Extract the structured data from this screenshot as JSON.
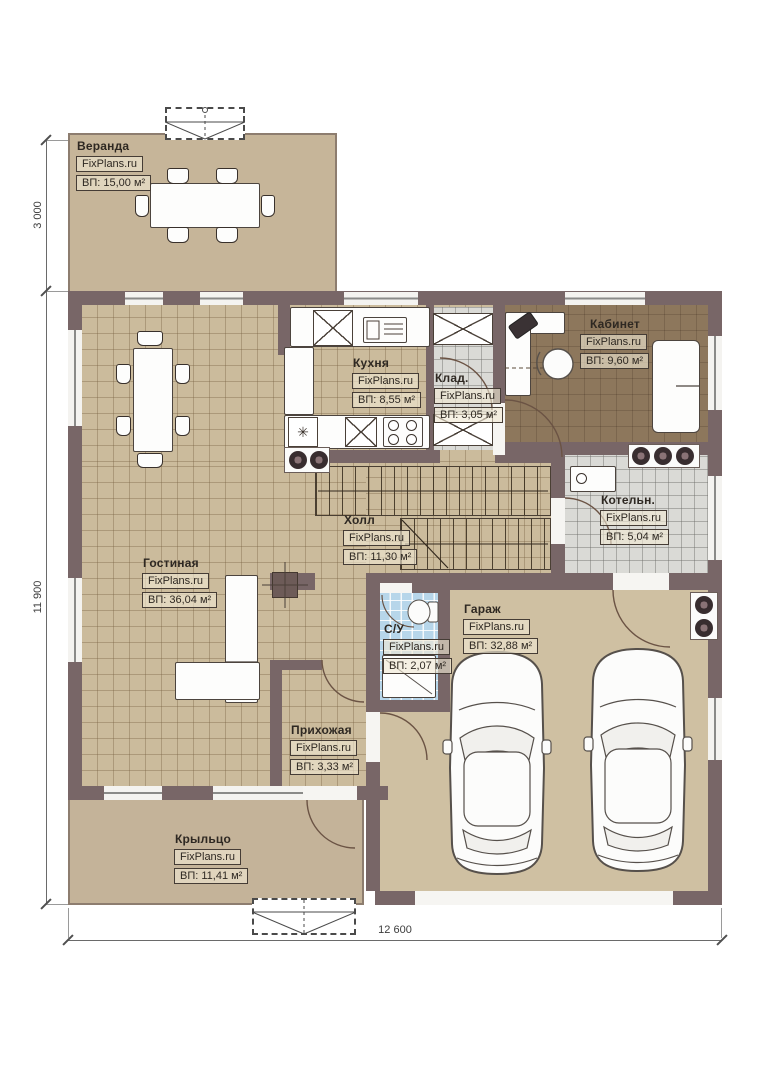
{
  "plan": {
    "brand": "FixPlans.ru",
    "dimensions": {
      "left_top": "3 000",
      "left_side": "11 900",
      "bottom": "12 600"
    },
    "icons": {
      "freezer": "✳"
    },
    "colors": {
      "wall": "#786667",
      "floor_tan": "#cbbb9c",
      "floor_office": "#8d775c",
      "floor_grey": "#dadad6",
      "floor_blue": "#b7d6ea",
      "floor_garage": "#cfc0a2",
      "veranda": "#c6b599",
      "porch": "#c4b399"
    },
    "rooms": [
      {
        "id": "veranda",
        "name": "Веранда",
        "brand": "FixPlans.ru",
        "area": "ВП: 15,00 м²"
      },
      {
        "id": "kitchen",
        "name": "Кухня",
        "brand": "FixPlans.ru",
        "area": "ВП: 8,55 м²"
      },
      {
        "id": "storage",
        "name": "Клад.",
        "brand": "FixPlans.ru",
        "area": "ВП: 3,05 м²"
      },
      {
        "id": "office",
        "name": "Кабинет",
        "brand": "FixPlans.ru",
        "area": "ВП: 9,60 м²"
      },
      {
        "id": "boiler",
        "name": "Котельн.",
        "brand": "FixPlans.ru",
        "area": "ВП: 5,04 м²"
      },
      {
        "id": "hall",
        "name": "Холл",
        "brand": "FixPlans.ru",
        "area": "ВП: 11,30 м²"
      },
      {
        "id": "living",
        "name": "Гостиная",
        "brand": "FixPlans.ru",
        "area": "ВП: 36,04 м²"
      },
      {
        "id": "wc",
        "name": "С/У",
        "brand": "FixPlans.ru",
        "area": "ВП: 2,07 м²"
      },
      {
        "id": "garage",
        "name": "Гараж",
        "brand": "FixPlans.ru",
        "area": "ВП: 32,88 м²"
      },
      {
        "id": "entry",
        "name": "Прихожая",
        "brand": "FixPlans.ru",
        "area": "ВП: 3,33 м²"
      },
      {
        "id": "porch",
        "name": "Крыльцо",
        "brand": "FixPlans.ru",
        "area": "ВП: 11,41 м²"
      }
    ]
  }
}
